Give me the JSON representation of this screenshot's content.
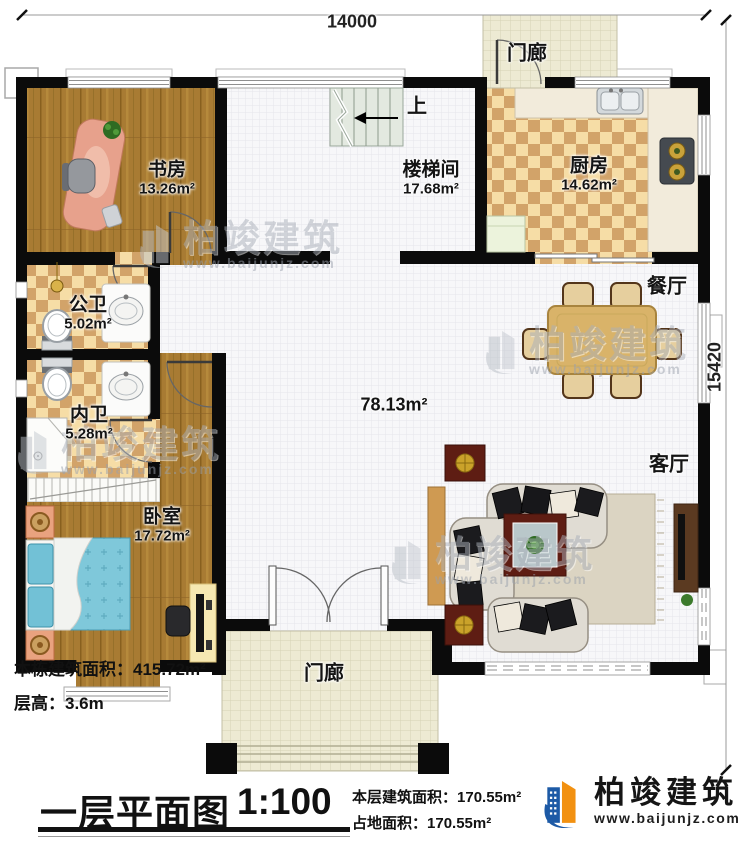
{
  "plan": {
    "dim_top": "14000",
    "dim_right": "15420",
    "rooms": {
      "porch_top": {
        "name": "门廊"
      },
      "study": {
        "name": "书房",
        "area": "13.26m²"
      },
      "stairwell": {
        "name": "楼梯间",
        "area": "17.68m²",
        "up": "上"
      },
      "kitchen": {
        "name": "厨房",
        "area": "14.62m²"
      },
      "dining": {
        "name": "餐厅"
      },
      "public_bath": {
        "name": "公卫",
        "area": "5.02m²"
      },
      "private_bath": {
        "name": "内卫",
        "area": "5.28m²"
      },
      "bedroom": {
        "name": "卧室",
        "area": "17.72m²"
      },
      "living": {
        "name": "客厅"
      },
      "hall": {
        "area": "78.13m²"
      },
      "porch_bottom": {
        "name": "门廊"
      }
    }
  },
  "info": {
    "building_area_label": "本栋建筑面积：",
    "building_area_value": "415.72m²",
    "floor_height_label": "层高：",
    "floor_height_value": "3.6m"
  },
  "titlebar": {
    "title": "一层平面图",
    "scale": "1:100",
    "floor_area_label": "本层建筑面积：",
    "floor_area_value": "170.55m²",
    "land_area_label": "占地面积：",
    "land_area_value": "170.55m²"
  },
  "brand": {
    "name": "柏竣建筑",
    "url": "www.baijunjz.com"
  },
  "watermark": {
    "name": "柏竣建筑",
    "url": "www.baijunjz.com"
  },
  "colors": {
    "accent_blue": "#1d5aa6",
    "accent_orange": "#f29111",
    "wall": "#0b0b0b"
  }
}
